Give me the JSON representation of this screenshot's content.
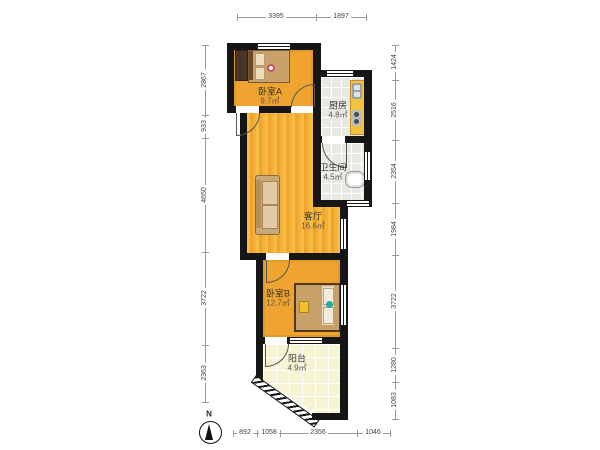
{
  "rooms": {
    "bedroom_a": {
      "name": "卧室A",
      "area": "9.7㎡"
    },
    "kitchen": {
      "name": "厨房",
      "area": "4.8㎡"
    },
    "bathroom": {
      "name": "卫生间",
      "area": "4.5㎡"
    },
    "living_room": {
      "name": "客厅",
      "area": "16.6㎡"
    },
    "bedroom_b": {
      "name": "卧室B",
      "area": "12.7㎡"
    },
    "balcony": {
      "name": "阳台",
      "area": "4.9㎡"
    }
  },
  "dimensions": {
    "top": [
      "3395",
      "1897"
    ],
    "bottom": [
      "892",
      "1058",
      "2356",
      "1046"
    ],
    "left": [
      "2867",
      "933",
      "4650",
      "3722",
      "2363"
    ],
    "right": [
      "1424",
      "2516",
      "2354",
      "1984",
      "3722",
      "1280",
      "1083"
    ]
  },
  "compass": {
    "north_label": "N"
  },
  "colors": {
    "wall": "#161616",
    "bedroom_floor": "#efa42f",
    "living_floor": "#f5b63e",
    "balcony_floor": "#f7f4d4",
    "tile_floor": "#e8e8e2",
    "counter": "#f2c33c"
  }
}
